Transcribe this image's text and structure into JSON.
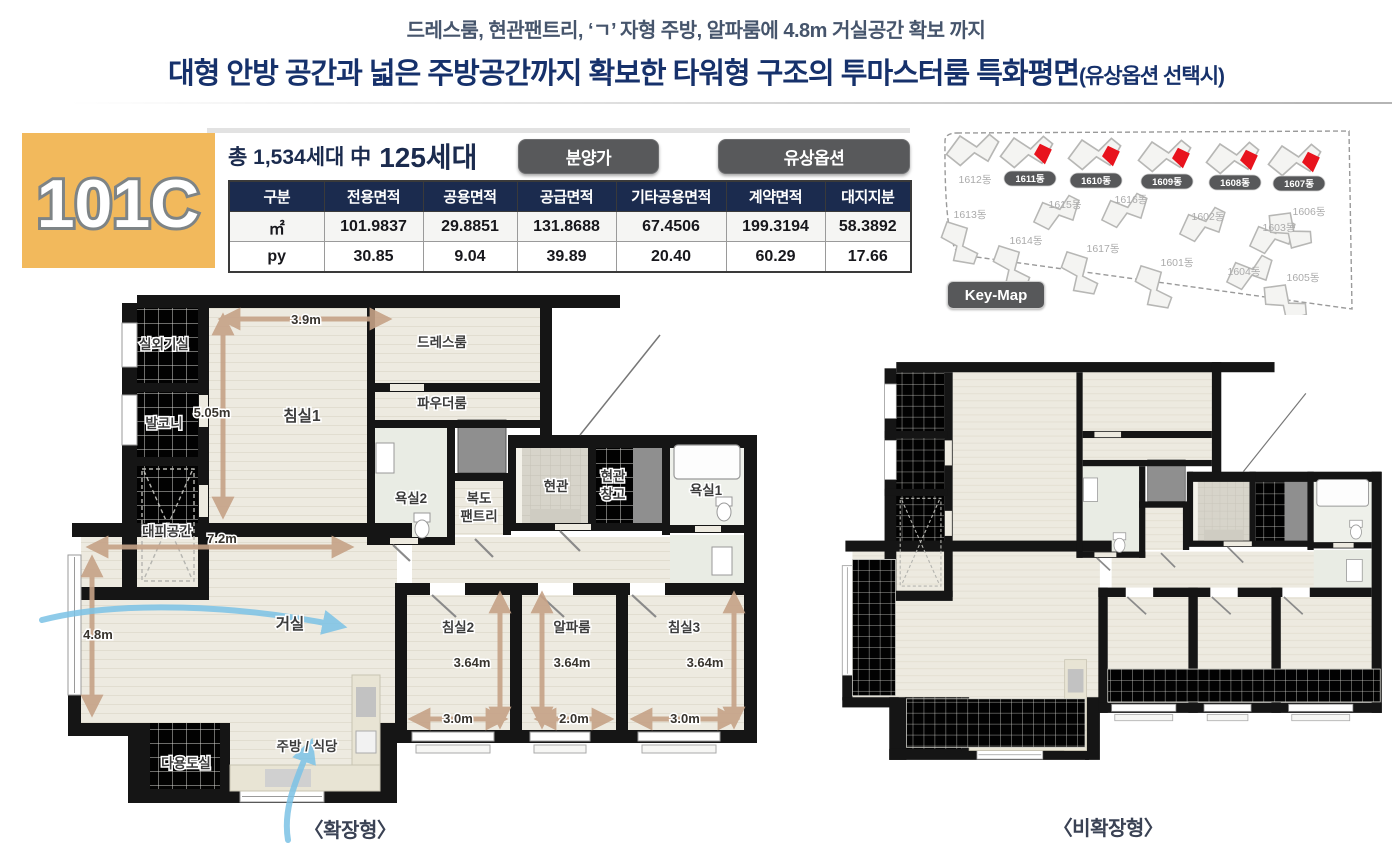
{
  "header": {
    "subtitle": "드레스룸, 현관팬트리, ‘ㄱ’ 자형 주방, 알파룸에 4.8m 거실공간 확보 까지",
    "title": "대형 안방 공간과 넓은 주방공간까지 확보한 타워형 구조의 투마스터룸 특화평면",
    "title_suffix": "(유상옵션 선택시)"
  },
  "unit": {
    "code": "101C",
    "households_prefix": "총 1,534세대 中",
    "households_count": "125세대",
    "buttons": [
      {
        "label": "분양가"
      },
      {
        "label": "유상옵션"
      }
    ]
  },
  "area_table": {
    "headers": [
      "구분",
      "전용면적",
      "공용면적",
      "공급면적",
      "기타공용면적",
      "계약면적",
      "대지지분"
    ],
    "rows": [
      {
        "label": "㎡",
        "values": [
          "101.9837",
          "29.8851",
          "131.8688",
          "67.4506",
          "199.3194",
          "58.3892"
        ]
      },
      {
        "label": "py",
        "values": [
          "30.85",
          "9.04",
          "39.89",
          "20.40",
          "60.29",
          "17.66"
        ]
      }
    ]
  },
  "keymap": {
    "label": "Key-Map",
    "buildings": [
      {
        "label": "1612동",
        "highlighted": false
      },
      {
        "label": "1611동",
        "highlighted": true
      },
      {
        "label": "1610동",
        "highlighted": true
      },
      {
        "label": "1609동",
        "highlighted": true
      },
      {
        "label": "1608동",
        "highlighted": true
      },
      {
        "label": "1607동",
        "highlighted": true
      },
      {
        "label": "1613동",
        "highlighted": false
      },
      {
        "label": "1615동",
        "highlighted": false
      },
      {
        "label": "1614동",
        "highlighted": false
      },
      {
        "label": "1616동",
        "highlighted": false
      },
      {
        "label": "1617동",
        "highlighted": false
      },
      {
        "label": "1602동",
        "highlighted": false
      },
      {
        "label": "1601동",
        "highlighted": false
      },
      {
        "label": "1603동",
        "highlighted": false
      },
      {
        "label": "1604동",
        "highlighted": false
      },
      {
        "label": "1606동",
        "highlighted": false
      },
      {
        "label": "1605동",
        "highlighted": false
      }
    ]
  },
  "floorplan": {
    "left_caption": "〈확장형〉",
    "right_caption": "〈비확장형〉",
    "rooms": {
      "outdoor_unit": "실외기실",
      "balcony": "발코니",
      "refuge": "대피공간",
      "bedroom1": "침실1",
      "dress_room": "드레스룸",
      "powder_room": "파우더룸",
      "bath2": "욕실2",
      "pantry_line1": "복도",
      "pantry_line2": "팬트리",
      "entrance": "현관",
      "entrance_storage_line1": "현관",
      "entrance_storage_line2": "창고",
      "bath1": "욕실1",
      "living": "거실",
      "bedroom2": "침실2",
      "alpha_room": "알파룸",
      "bedroom3": "침실3",
      "utility": "다용도실",
      "kitchen": "주방 / 식당"
    },
    "dims": {
      "bed1_w": "3.9m",
      "bed1_h": "5.05m",
      "living_w": "7.2m",
      "living_h": "4.8m",
      "bed2_h": "3.64m",
      "bed2_w": "3.0m",
      "alpha_h": "3.64m",
      "alpha_w": "2.0m",
      "bed3_h": "3.64m",
      "bed3_w": "3.0m"
    }
  },
  "colors": {
    "accent_navy": "#1b2b4e",
    "badge_orange": "#f2b95c",
    "button_gray": "#58595b",
    "highlight_red": "#e8131d",
    "dim_tan": "#c6a287",
    "flow_blue": "#7cc3e6"
  }
}
